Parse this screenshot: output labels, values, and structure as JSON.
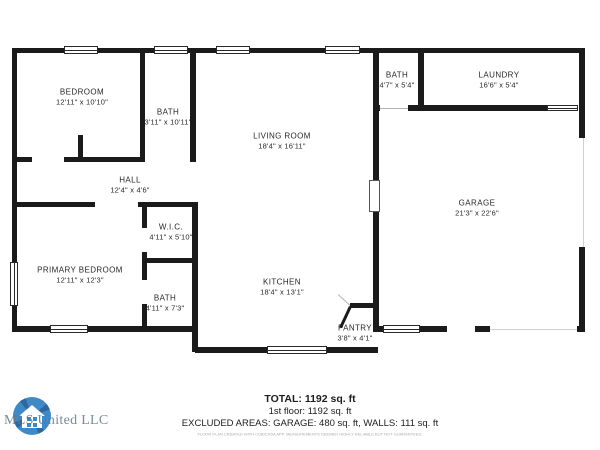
{
  "rooms": [
    {
      "name": "BEDROOM",
      "dims": "12'11\" x 10'10\""
    },
    {
      "name": "BATH",
      "dims": "3'11\" x 10'11\""
    },
    {
      "name": "LIVING ROOM",
      "dims": "18'4\" x 16'11\""
    },
    {
      "name": "BATH",
      "dims": "4'7\" x 5'4\""
    },
    {
      "name": "LAUNDRY",
      "dims": "16'6\" x 5'4\""
    },
    {
      "name": "GARAGE",
      "dims": "21'3\" x 22'6\""
    },
    {
      "name": "HALL",
      "dims": "12'4\" x 4'6\""
    },
    {
      "name": "W.I.C.",
      "dims": "4'11\" x 5'10\""
    },
    {
      "name": "PRIMARY BEDROOM",
      "dims": "12'11\" x 12'3\""
    },
    {
      "name": "BATH",
      "dims": "4'11\" x 7'3\""
    },
    {
      "name": "KITCHEN",
      "dims": "18'4\" x 13'1\""
    },
    {
      "name": "PANTRY",
      "dims": "3'8\" x 4'1\""
    }
  ],
  "summary": {
    "total": "TOTAL: 1192 sq. ft",
    "floor": "1st floor: 1192 sq. ft",
    "excluded": "EXCLUDED AREAS: GARAGE: 480 sq. ft, WALLS: 111 sq. ft",
    "disclaimer": "FLOOR PLAN CREATED WITH CUBICASA APP. MEASUREMENTS DEEMED HIGHLY RELIABLE BUT NOT GUARANTEED."
  },
  "branding": {
    "logo_text": "MLS United LLC"
  },
  "colors": {
    "wall": "#1b1b1b",
    "logo_blue": "#2f80c3",
    "logo_dark_blue": "#1c5d97",
    "logo_text": "#5d7889"
  }
}
